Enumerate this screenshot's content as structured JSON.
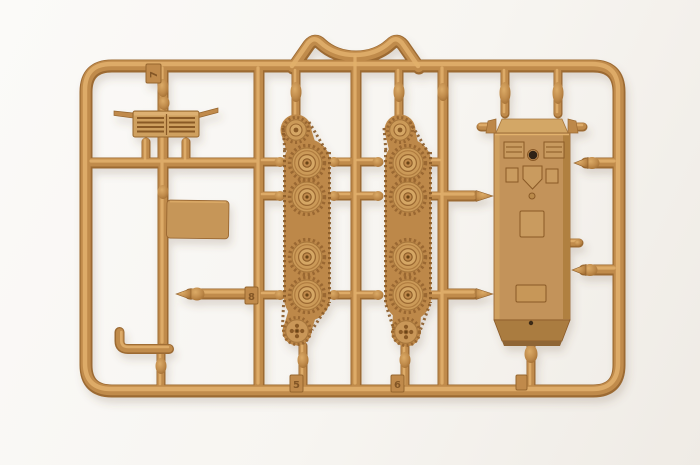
{
  "image": {
    "description": "Photo of a tan plastic model-kit sprue holding small tank parts on a white background"
  },
  "colors": {
    "photo_background": "#f7f4f0",
    "sprue_base": "#c08b4b",
    "sprue_highlight": "#e2b06c",
    "sprue_shadow": "#9c6a33",
    "part_face": "#c79759",
    "hole_dark": "#2e2013"
  },
  "sprue": {
    "mold_numbers": {
      "top_left": "7",
      "mid_left": "8",
      "bottom_track_left": "5",
      "bottom_track_right": "6"
    },
    "parts": [
      {
        "name": "engine-grille"
      },
      {
        "name": "flat-plate"
      },
      {
        "name": "tow-hook"
      },
      {
        "name": "gun-barrel"
      },
      {
        "name": "track-run-left"
      },
      {
        "name": "track-run-right"
      },
      {
        "name": "hull-top"
      }
    ]
  }
}
